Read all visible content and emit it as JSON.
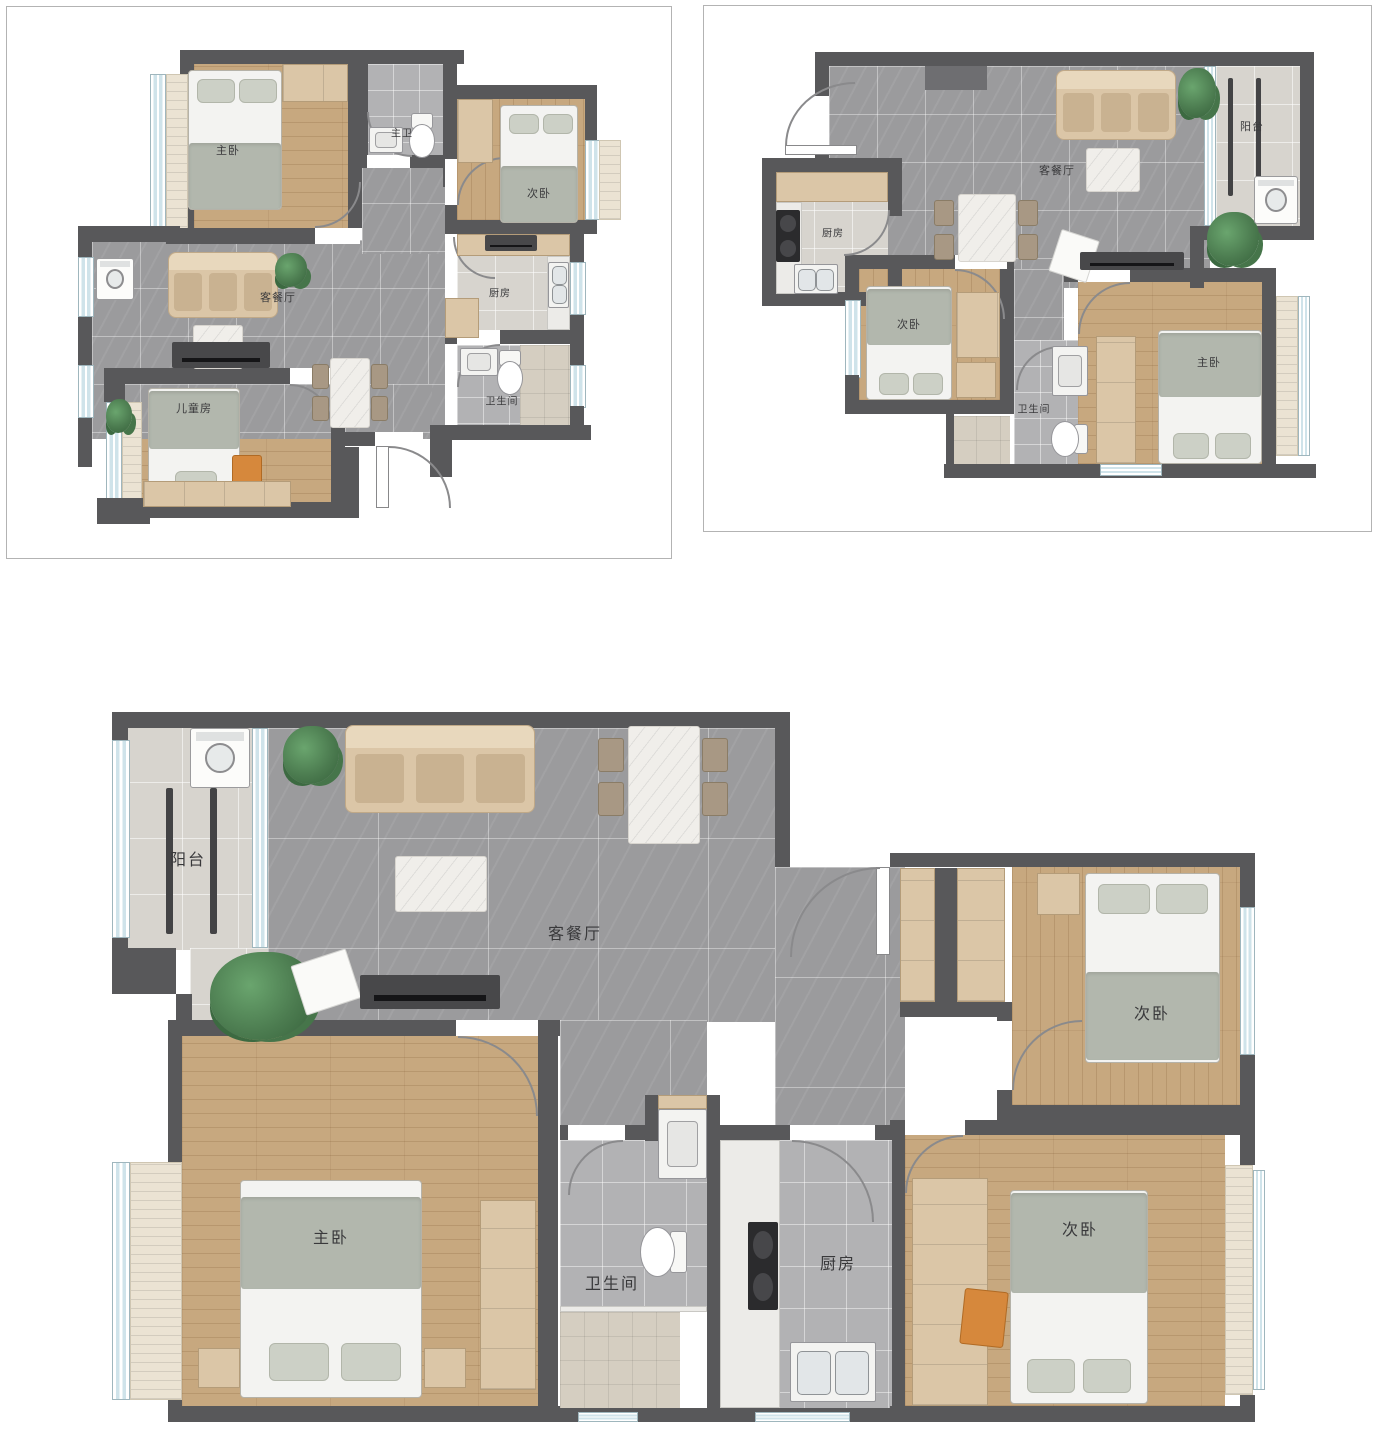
{
  "palette": {
    "wall": "#58585a",
    "tile_gray": "#9b9b9d",
    "tile_light": "#d7d4ce",
    "tile_bath": "#b2b2b4",
    "tile_shower": "#d5cec1",
    "wood": "#c7a87f",
    "furn": "#dbc6a7",
    "furn_dark": "#c9b291",
    "blanket": "#b2b7ad",
    "sheet": "#f3f3f1",
    "pillow": "#ccd0c6",
    "window": "#cfe3ea",
    "tv": "#48484a",
    "plant": "#4c7c50",
    "accent_orange": "#d6883c"
  },
  "plans": [
    {
      "name": "floor-plan-top-left",
      "rooms": {
        "master": "主卧",
        "master_bath": "主卫",
        "second": "次卧",
        "living": "客餐厅",
        "kitchen": "厨房",
        "bath": "卫生间",
        "kids": "儿童房"
      }
    },
    {
      "name": "floor-plan-top-right",
      "rooms": {
        "living": "客餐厅",
        "balcony": "阳台",
        "kitchen": "厨房",
        "second": "次卧",
        "bath": "卫生间",
        "master": "主卧"
      }
    },
    {
      "name": "floor-plan-bottom",
      "rooms": {
        "balcony": "阳台",
        "living": "客餐厅",
        "master": "主卧",
        "bath": "卫生间",
        "kitchen": "厨房",
        "second_a": "次卧",
        "second_b": "次卧"
      }
    }
  ]
}
